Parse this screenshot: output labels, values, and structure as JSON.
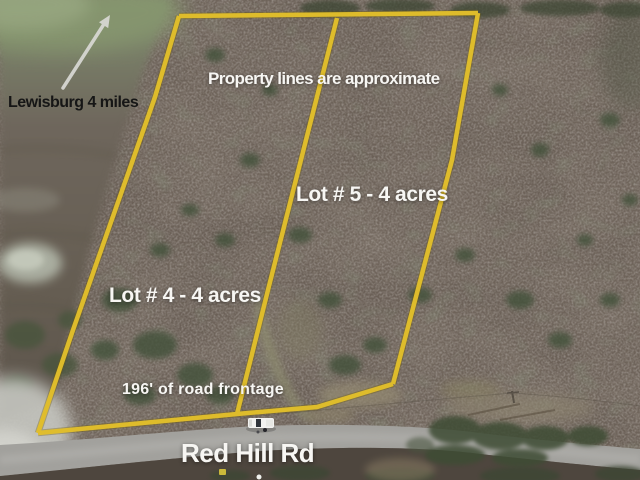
{
  "overlay": {
    "direction_label": "Lewisburg 4 miles",
    "disclaimer": "Property lines are approximate",
    "lots": [
      {
        "id": "lot-4",
        "label": "Lot # 4 - 4 acres"
      },
      {
        "id": "lot-5",
        "label": "Lot # 5 - 4 acres"
      }
    ],
    "frontage_label": "196' of road frontage",
    "road_label": "Red Hill Rd",
    "icons": [
      {
        "name": "direction-arrow-icon",
        "meaning": "arrow pointing toward Lewisburg"
      }
    ],
    "colors": {
      "boundary_line": "#e2bf2b",
      "annotation_white": "#f7f6f3",
      "annotation_black": "#161616",
      "arrow": "#d9d9d5",
      "road_gray": "#a2a19d",
      "forest_brown": "#6a5f56",
      "field_green": "#87976f"
    }
  }
}
